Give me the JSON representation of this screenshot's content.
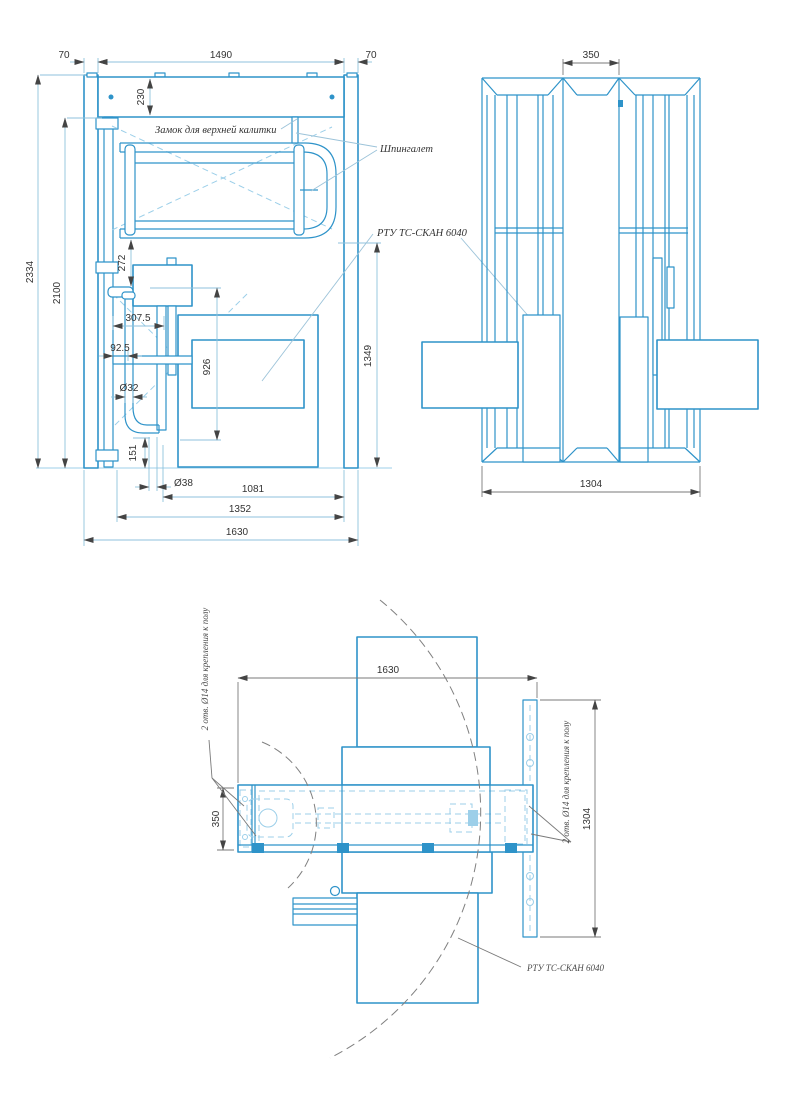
{
  "drawing": {
    "product": "РТУ ТС-СКАН 6040",
    "colors": {
      "line_blue": "#2E93C9",
      "hidden_light_blue": "#9CCFE9",
      "dim_line_blue": "#8FC2DC",
      "dim_gray": "#7a7a7a",
      "text_color": "#333333"
    }
  },
  "front_view": {
    "dims": {
      "left_post_width": "70",
      "opening_width": "1490",
      "right_post_width": "70",
      "beam_height": "230",
      "overall_height": "2334",
      "clear_height": "2100",
      "gate_to_box": "272",
      "hinge_offset": "307.5",
      "arm_offset": "92.5",
      "tube_diameter": "Ø32",
      "base_height": "151",
      "scanner_height": "926",
      "gate_bottom_height": "1349",
      "post_diameter": "Ø38",
      "scanner_offset": "1081",
      "arm_span": "1352",
      "overall_width": "1630"
    },
    "labels": {
      "lock": "Замок для верхней калитки",
      "latch": "Шпингалет",
      "scanner": "РТУ ТС-СКАН 6040"
    }
  },
  "side_view": {
    "dims": {
      "passage_width": "350",
      "overall_depth": "1304"
    }
  },
  "plan_view": {
    "dims": {
      "overall_width": "1630",
      "housing_depth": "350",
      "plate_length": "1304"
    },
    "labels": {
      "anchor_holes_left": "2 отв. Ø14 для крепления к полу",
      "anchor_holes_right": "2 отв. Ø14 для крепления к полу",
      "scanner": "РТУ ТС-СКАН 6040"
    }
  }
}
